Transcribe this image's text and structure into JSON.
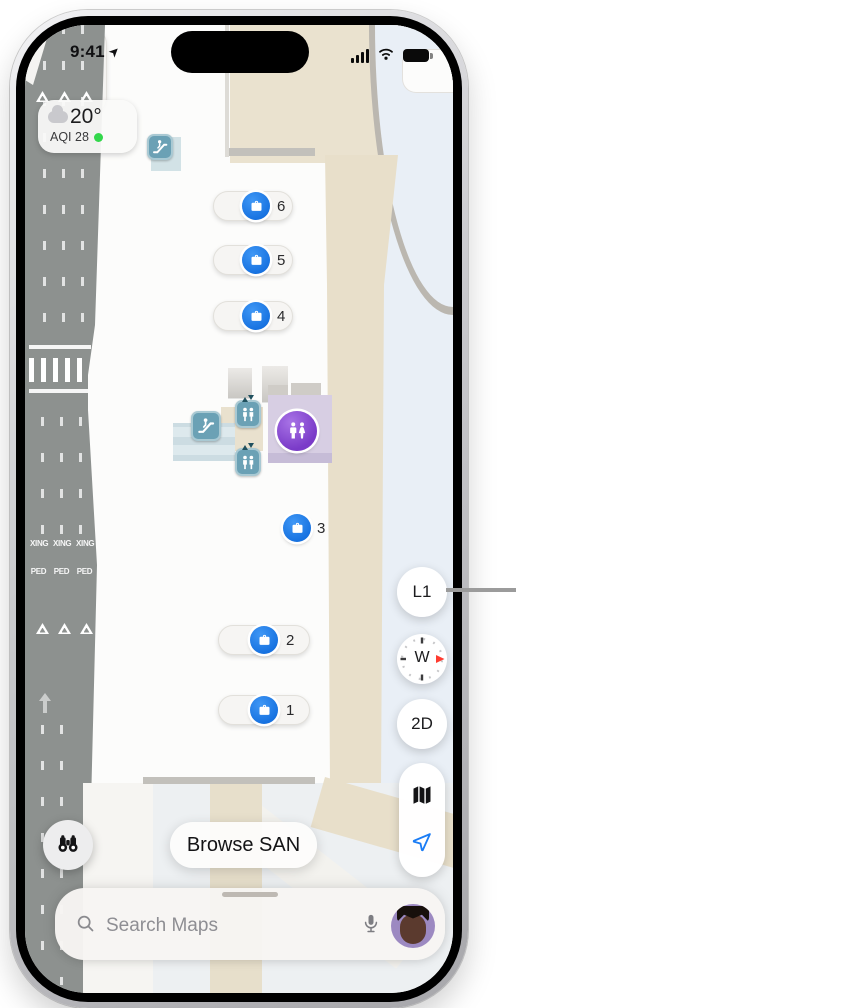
{
  "status_bar": {
    "time": "9:41"
  },
  "weather_widget": {
    "temperature": "20°",
    "air_quality": "AQI 28"
  },
  "road": {
    "crossing_text": "XING",
    "pedestrian_text": "PED"
  },
  "baggage_claims": [
    {
      "number": "6"
    },
    {
      "number": "5"
    },
    {
      "number": "4"
    },
    {
      "number": "3"
    },
    {
      "number": "2"
    },
    {
      "number": "1"
    }
  ],
  "map_controls": {
    "level_button": "L1",
    "compass_direction": "W",
    "view_mode_button": "2D"
  },
  "browse_button": {
    "label": "Browse SAN"
  },
  "search_bar": {
    "placeholder": "Search Maps"
  },
  "icons": {
    "status": [
      "location-nav-icon",
      "cellular-signal-icon",
      "wifi-icon",
      "battery-icon"
    ],
    "map_poi": [
      "escalator-icon",
      "elevator-icon",
      "restroom-icon",
      "baggage-claim-icon"
    ],
    "controls": [
      "compass-icon",
      "map-mode-icon",
      "location-arrow-icon",
      "binoculars-icon"
    ],
    "search": [
      "magnifier-icon",
      "microphone-icon",
      "user-avatar"
    ]
  },
  "colors": {
    "claim_blue": "#1671e0",
    "poi_teal": "#6ba1b5",
    "restroom_purple": "#7a3bc8",
    "aqi_green": "#32d74b",
    "compass_needle_red": "#ff3b30",
    "road_gray": "#8d918f",
    "wall_beige": "#e8dfca",
    "callout_gray": "#9b9b9b"
  }
}
